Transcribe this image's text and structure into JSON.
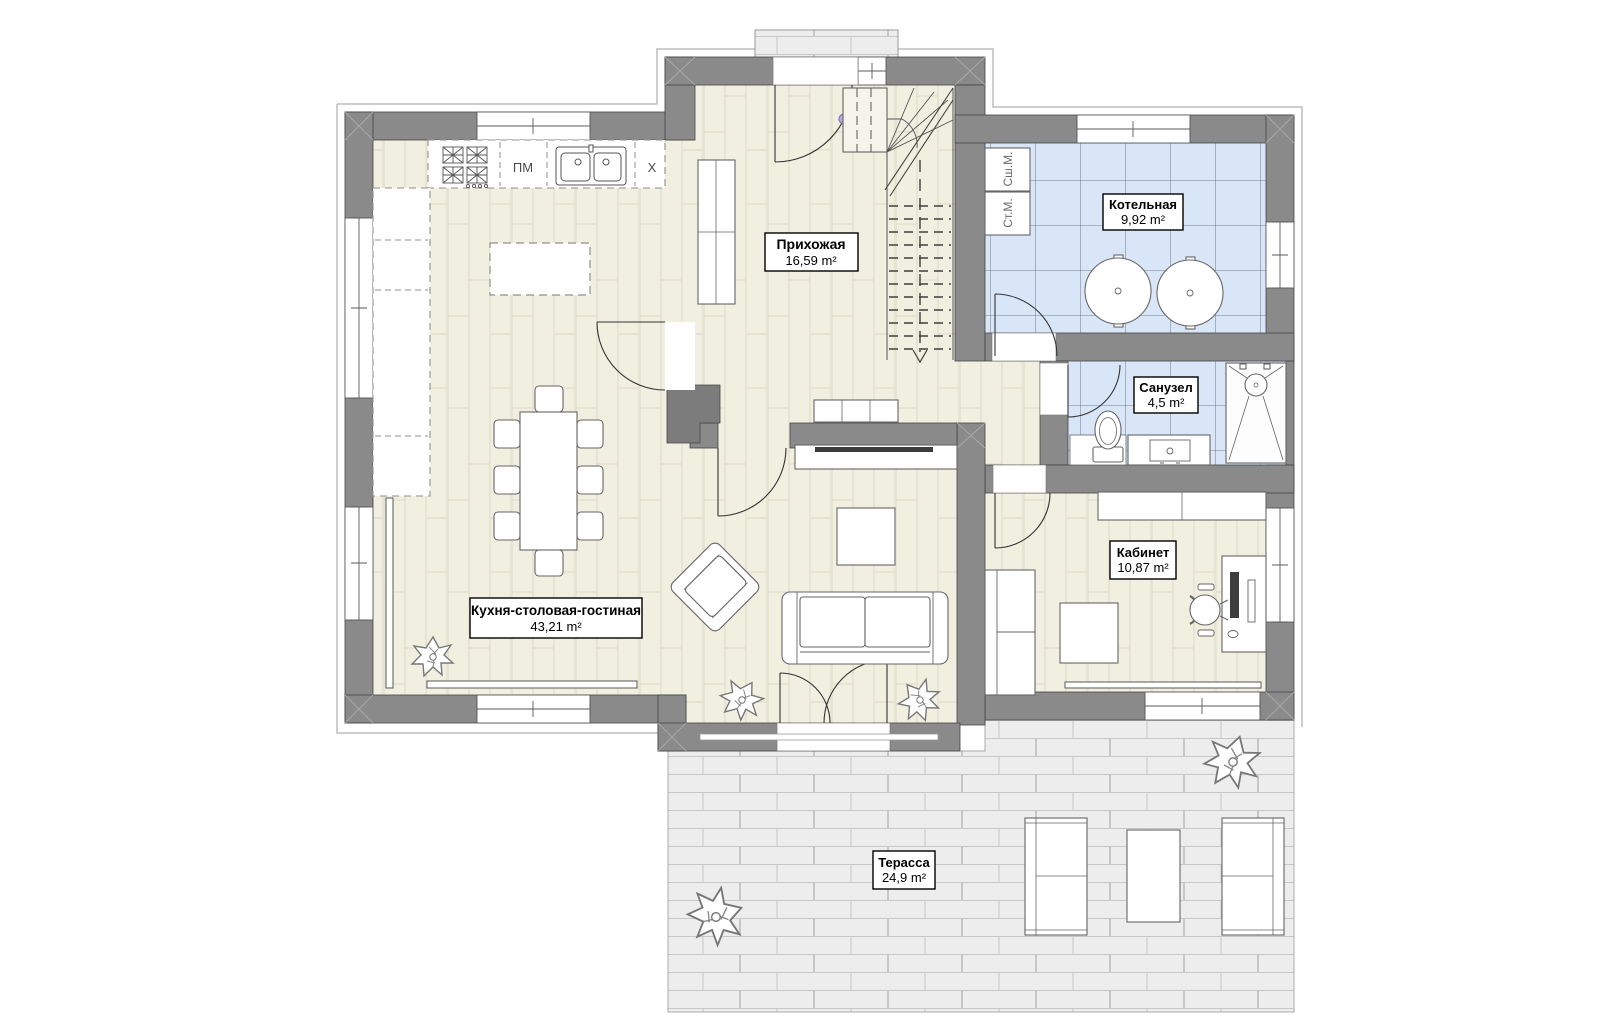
{
  "plan": {
    "rooms": {
      "hallway": {
        "name": "Прихожая",
        "area": "16,59 m²"
      },
      "boiler": {
        "name": "Котельная",
        "area": "9,92 m²"
      },
      "bathroom": {
        "name": "Санузел",
        "area": "4,5 m²"
      },
      "office": {
        "name": "Кабинет",
        "area": "10,87 m²"
      },
      "kitchen_living": {
        "name": "Кухня-столовая-гостиная",
        "area": "43,21 m²"
      },
      "terrace": {
        "name": "Терасса",
        "area": "24,9 m²"
      }
    },
    "appliances": {
      "dishwasher": "ПМ",
      "fridge": "X",
      "washing_machine": "Ст.М.",
      "drying_machine": "Сш.М."
    },
    "colors": {
      "wall": "#8a8a8a",
      "wood_floor": "#f1efe0",
      "tile_floor": "#d8e6f8",
      "terrace_paving": "#ededed",
      "label_border": "#000000"
    }
  }
}
